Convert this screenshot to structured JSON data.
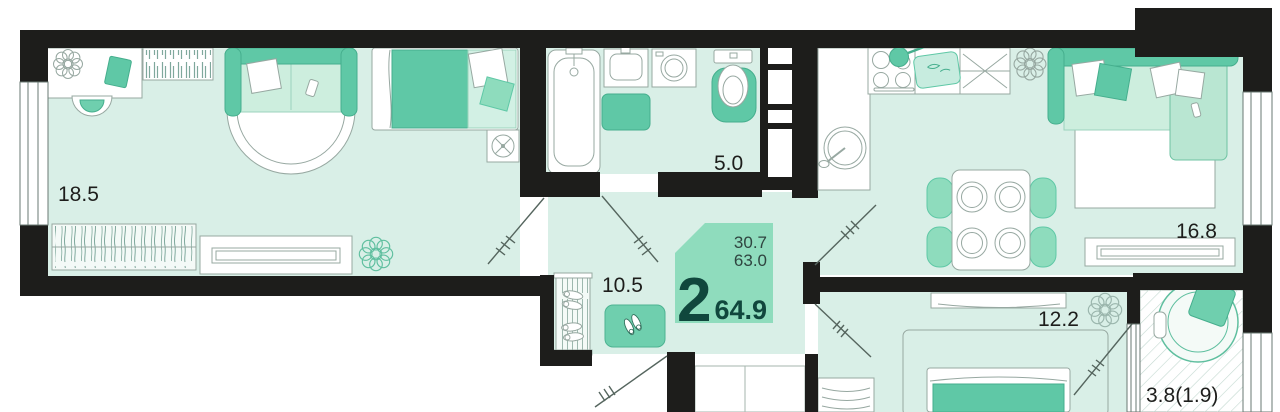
{
  "floor_plan": {
    "badge": {
      "rooms_count": "2",
      "total_area": "64.9",
      "living_area": "30.7",
      "area_no_balcony": "63.0"
    },
    "labels": {
      "living_room": "18.5",
      "bathroom": "5.0",
      "hallway": "10.5",
      "kitchen_living_room": "16.8",
      "bedroom": "12.2",
      "balcony": "3.8(1.9)"
    },
    "colors": {
      "wall": "#1d1d1b",
      "floor": "#d9efe7",
      "accent_green": "#5fc8a6",
      "accent_light": "#cdeede",
      "badge_bg": "#8fdcbd",
      "badge_text": "#10473d",
      "label_text": "#1d1d1b"
    }
  }
}
